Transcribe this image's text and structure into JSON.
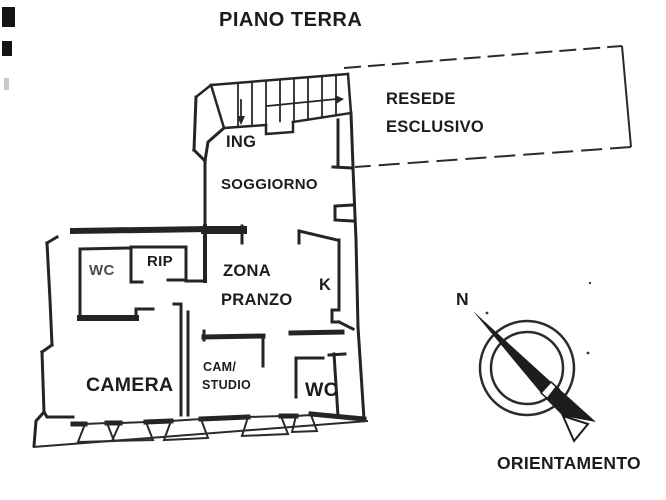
{
  "title": "PIANO TERRA",
  "plan": {
    "rooms": {
      "ing": "ING",
      "soggiorno": "SOGGIORNO",
      "wc_upper": "WC",
      "rip": "RIP",
      "zona_pranzo_line1": "ZONA",
      "zona_pranzo_line2": "PRANZO",
      "kitchen": "K",
      "camera": "CAMERA",
      "cam_studio_line1": "CAM/",
      "cam_studio_line2": "STUDIO",
      "wc_lower": "WC"
    },
    "outdoor": {
      "line1": "RESEDE",
      "line2": "ESCLUSIVO"
    }
  },
  "compass": {
    "north_label": "N",
    "caption": "ORIENTAMENTO"
  },
  "colors": {
    "ink": "#222222",
    "wc_label_gray": "#4d4d4d",
    "background": "#ffffff"
  }
}
